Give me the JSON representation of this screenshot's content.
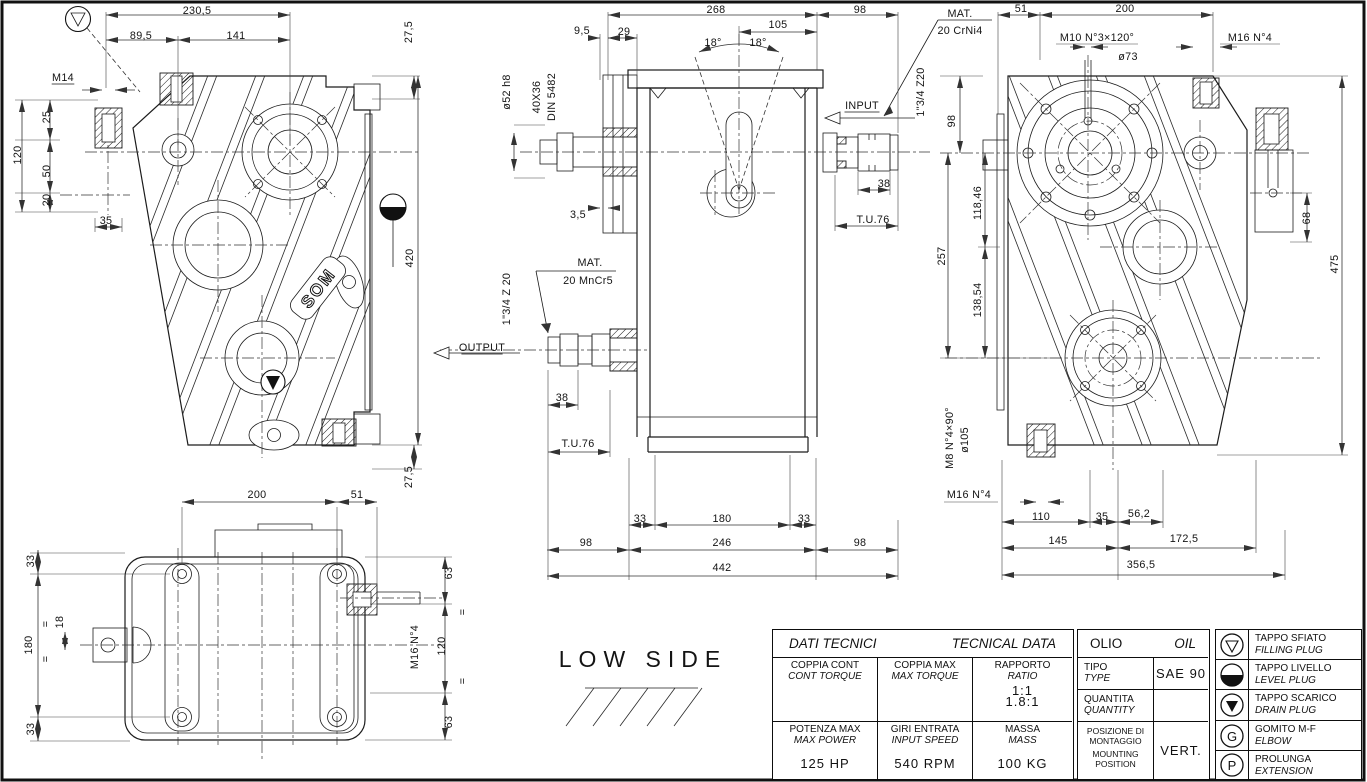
{
  "som": "SOM",
  "labels": [
    {
      "t": "230,5",
      "x": 197,
      "y": 10
    },
    {
      "t": "89,5",
      "x": 141,
      "y": 35
    },
    {
      "t": "141",
      "x": 236,
      "y": 35
    },
    {
      "t": "27,5",
      "x": 408,
      "y": 32,
      "r": -90
    },
    {
      "t": "M14",
      "x": 63,
      "y": 77,
      "u": 1
    },
    {
      "t": "25",
      "x": 46,
      "y": 117,
      "r": -90
    },
    {
      "t": "120",
      "x": 17,
      "y": 155,
      "r": -90
    },
    {
      "t": "50",
      "x": 46,
      "y": 171,
      "r": -90
    },
    {
      "t": "20",
      "x": 46,
      "y": 200,
      "r": -90
    },
    {
      "t": "35",
      "x": 106,
      "y": 220
    },
    {
      "t": "420",
      "x": 409,
      "y": 258,
      "r": -90
    },
    {
      "t": "27,5",
      "x": 408,
      "y": 477,
      "r": -90
    },
    {
      "t": "200",
      "x": 257,
      "y": 494
    },
    {
      "t": "51",
      "x": 357,
      "y": 494
    },
    {
      "t": "33",
      "x": 30,
      "y": 561,
      "r": -90
    },
    {
      "t": "180",
      "x": 28,
      "y": 645,
      "r": -90
    },
    {
      "t": "33",
      "x": 30,
      "y": 729,
      "r": -90
    },
    {
      "t": "=",
      "x": 45,
      "y": 624,
      "r": -90
    },
    {
      "t": "18",
      "x": 59,
      "y": 622,
      "r": -90
    },
    {
      "t": "=",
      "x": 45,
      "y": 659,
      "r": -90
    },
    {
      "t": "63",
      "x": 448,
      "y": 573,
      "r": -90
    },
    {
      "t": "M16 N°4",
      "x": 414,
      "y": 647,
      "r": -90
    },
    {
      "t": "120",
      "x": 441,
      "y": 646,
      "r": -90
    },
    {
      "t": "=",
      "x": 462,
      "y": 612,
      "r": -90
    },
    {
      "t": "=",
      "x": 462,
      "y": 681,
      "r": -90
    },
    {
      "t": "63",
      "x": 448,
      "y": 722,
      "r": -90
    },
    {
      "t": "LOW SIDE",
      "x": 643,
      "y": 663,
      "s": "low"
    },
    {
      "t": "268",
      "x": 716,
      "y": 9
    },
    {
      "t": "98",
      "x": 860,
      "y": 9
    },
    {
      "t": "9,5",
      "x": 582,
      "y": 30
    },
    {
      "t": "29",
      "x": 624,
      "y": 31
    },
    {
      "t": "105",
      "x": 778,
      "y": 24
    },
    {
      "t": "18°",
      "x": 713,
      "y": 42
    },
    {
      "t": "18°",
      "x": 758,
      "y": 42
    },
    {
      "t": "MAT.",
      "x": 960,
      "y": 13
    },
    {
      "t": "20 CrNi4",
      "x": 960,
      "y": 30
    },
    {
      "t": "ø52 h8",
      "x": 506,
      "y": 92,
      "r": -90
    },
    {
      "t": "40X36",
      "x": 536,
      "y": 97,
      "r": -90
    },
    {
      "t": "DIN 5482",
      "x": 551,
      "y": 97,
      "r": -90
    },
    {
      "t": "INPUT",
      "x": 862,
      "y": 105,
      "u": 1
    },
    {
      "t": "1\"3/4 Z20",
      "x": 920,
      "y": 92,
      "r": -90
    },
    {
      "t": "38",
      "x": 884,
      "y": 183
    },
    {
      "t": "T.U.76",
      "x": 873,
      "y": 219
    },
    {
      "t": "3,5",
      "x": 578,
      "y": 214
    },
    {
      "t": "MAT.",
      "x": 590,
      "y": 262
    },
    {
      "t": "20 MnCr5",
      "x": 588,
      "y": 280
    },
    {
      "t": "1\"3/4 Z 20",
      "x": 506,
      "y": 299,
      "r": -90
    },
    {
      "t": "OUTPUT",
      "x": 482,
      "y": 347,
      "u": 1
    },
    {
      "t": "38",
      "x": 562,
      "y": 397
    },
    {
      "t": "T.U.76",
      "x": 578,
      "y": 443
    },
    {
      "t": "33",
      "x": 640,
      "y": 518
    },
    {
      "t": "180",
      "x": 722,
      "y": 518
    },
    {
      "t": "33",
      "x": 804,
      "y": 518
    },
    {
      "t": "98",
      "x": 586,
      "y": 542
    },
    {
      "t": "246",
      "x": 722,
      "y": 542
    },
    {
      "t": "98",
      "x": 860,
      "y": 542
    },
    {
      "t": "442",
      "x": 722,
      "y": 567
    },
    {
      "t": "51",
      "x": 1021,
      "y": 8
    },
    {
      "t": "200",
      "x": 1125,
      "y": 8
    },
    {
      "t": "M10 N°3×120°",
      "x": 1097,
      "y": 37
    },
    {
      "t": "ø73",
      "x": 1128,
      "y": 56
    },
    {
      "t": "M16 N°4",
      "x": 1250,
      "y": 37
    },
    {
      "t": "98",
      "x": 951,
      "y": 121,
      "r": -90
    },
    {
      "t": "118,46",
      "x": 977,
      "y": 203,
      "r": -90
    },
    {
      "t": "257",
      "x": 941,
      "y": 256,
      "r": -90
    },
    {
      "t": "138,54",
      "x": 977,
      "y": 300,
      "r": -90
    },
    {
      "t": "68",
      "x": 1306,
      "y": 218,
      "r": -90
    },
    {
      "t": "475",
      "x": 1334,
      "y": 264,
      "r": -90
    },
    {
      "t": "M8 N°4×90°",
      "x": 949,
      "y": 438,
      "r": -90
    },
    {
      "t": "ø105",
      "x": 964,
      "y": 440,
      "r": -90
    },
    {
      "t": "M16 N°4",
      "x": 969,
      "y": 494
    },
    {
      "t": "110",
      "x": 1041,
      "y": 516
    },
    {
      "t": "35",
      "x": 1102,
      "y": 516
    },
    {
      "t": "56,2",
      "x": 1139,
      "y": 513
    },
    {
      "t": "145",
      "x": 1058,
      "y": 540
    },
    {
      "t": "172,5",
      "x": 1184,
      "y": 538
    },
    {
      "t": "356,5",
      "x": 1141,
      "y": 564
    }
  ],
  "tables": {
    "tech": {
      "title_it": "DATI TECNICI",
      "title_en": "TECNICAL DATA",
      "cells": [
        {
          "it": "COPPIA CONT",
          "en": "CONT TORQUE",
          "value": ""
        },
        {
          "it": "COPPIA MAX",
          "en": "MAX TORQUE",
          "value": ""
        },
        {
          "it": "RAPPORTO",
          "en": "RATIO",
          "value1": "1:1",
          "value2": "1.8:1"
        },
        {
          "it": "POTENZA MAX",
          "en": "MAX POWER",
          "value": "125 HP"
        },
        {
          "it": "GIRI ENTRATA",
          "en": "INPUT SPEED",
          "value": "540 RPM"
        },
        {
          "it": "MASSA",
          "en": "MASS",
          "value": "100 KG"
        }
      ]
    },
    "oil": {
      "title_it": "OLIO",
      "title_en": "OIL",
      "rows": [
        {
          "it": "TIPO",
          "en": "TYPE",
          "value": "SAE 90"
        },
        {
          "it": "QUANTITA",
          "en": "QUANTITY",
          "value": ""
        },
        {
          "it": "POSIZIONE DI MONTAGGIO",
          "en": "MOUNTING POSITION",
          "value": "VERT."
        }
      ]
    },
    "legend": {
      "rows": [
        {
          "symbol": "filling-plug",
          "it": "TAPPO SFIATO",
          "en": "FILLING PLUG"
        },
        {
          "symbol": "level-plug",
          "it": "TAPPO LIVELLO",
          "en": "LEVEL PLUG"
        },
        {
          "symbol": "drain-plug",
          "it": "TAPPO SCARICO",
          "en": "DRAIN PLUG"
        },
        {
          "symbol": "elbow",
          "letter": "G",
          "it": "GOMITO M-F",
          "en": "ELBOW"
        },
        {
          "symbol": "extension",
          "letter": "P",
          "it": "PROLUNGA",
          "en": "EXTENSION"
        }
      ]
    }
  }
}
